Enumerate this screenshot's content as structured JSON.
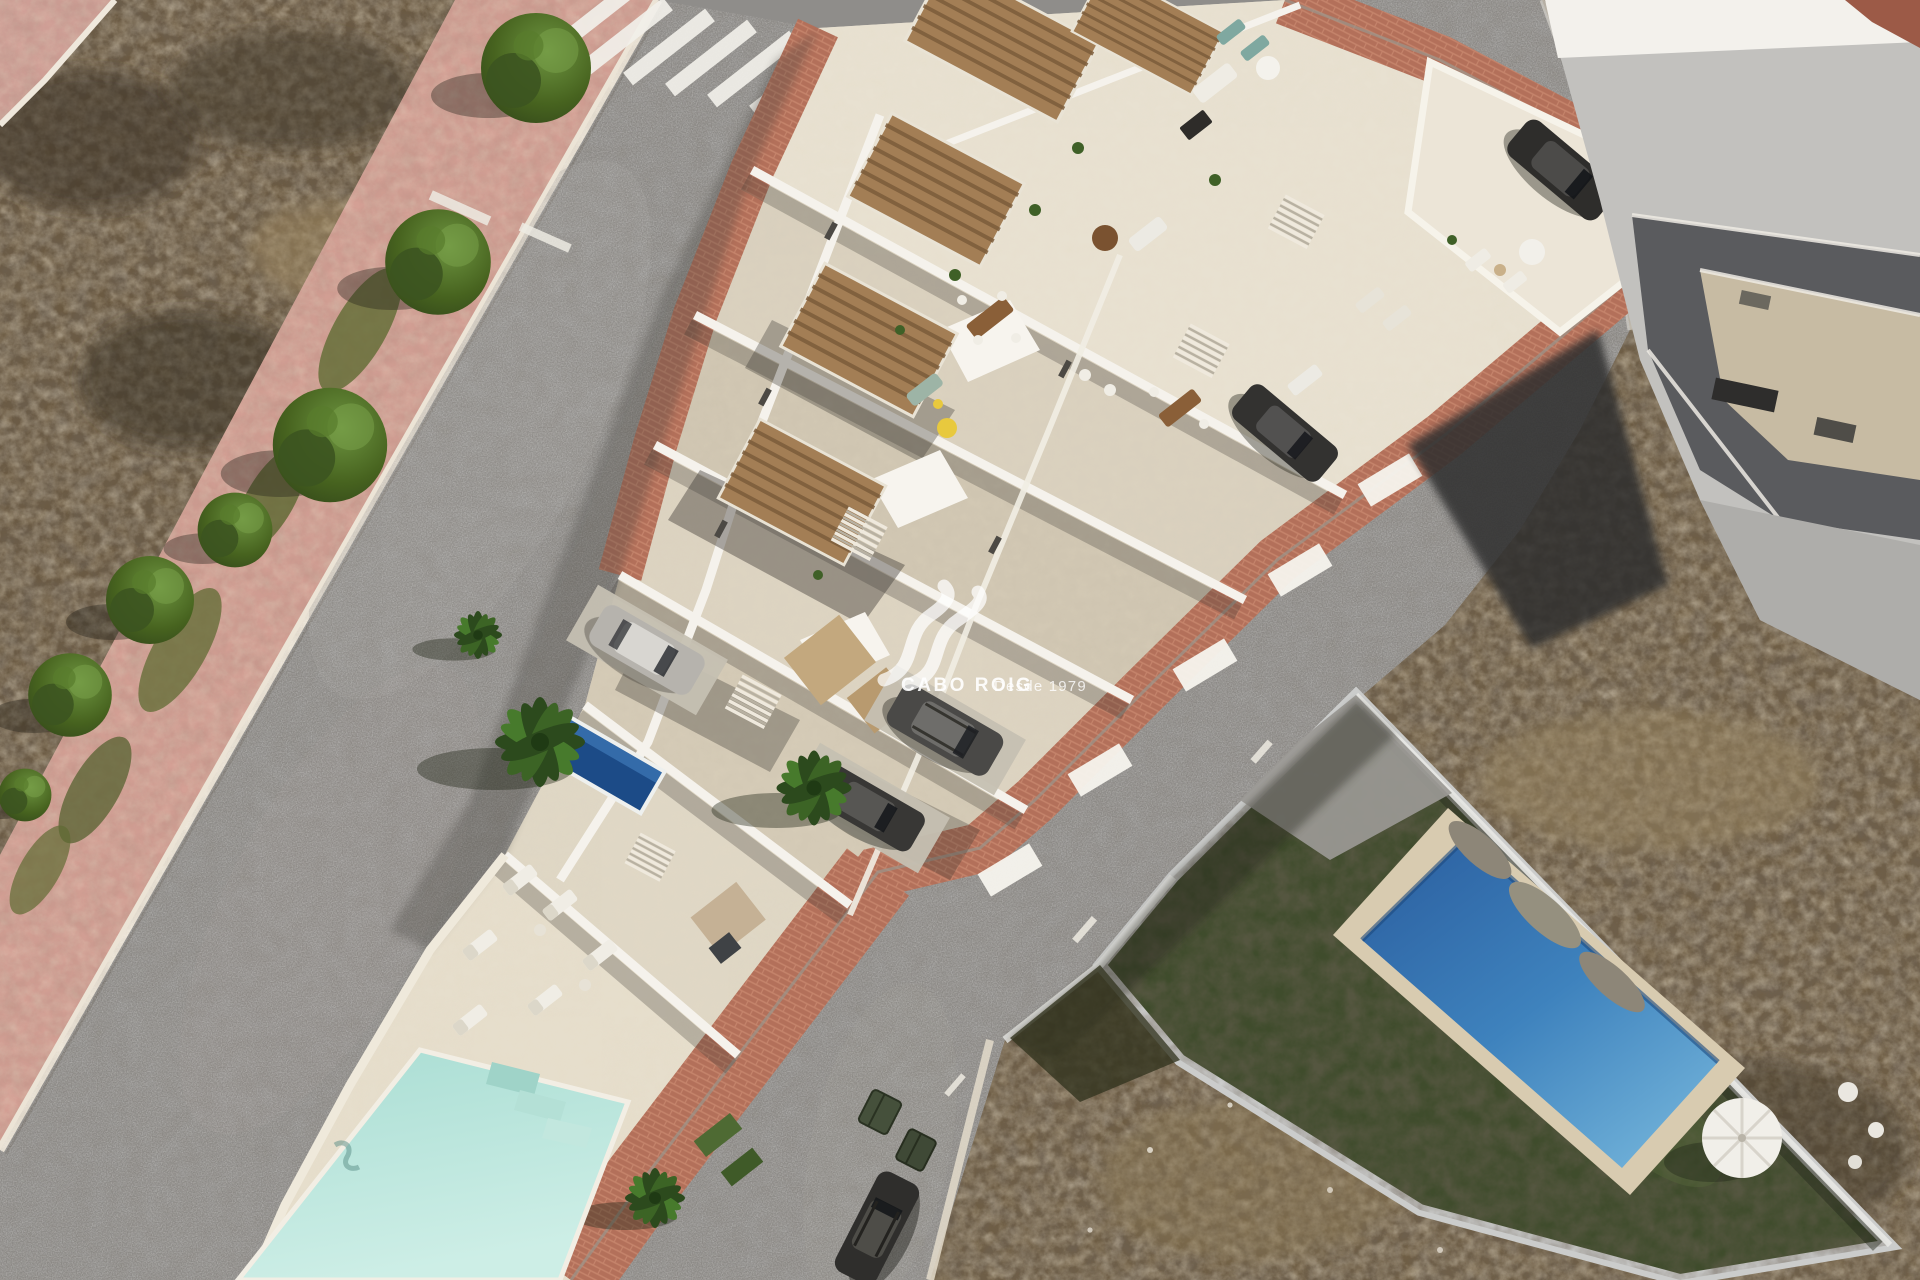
{
  "watermark": {
    "brand": "CABO ROIG",
    "tagline": "Desde 1979"
  },
  "scene": {
    "type": "aerial-3d-architectural-render",
    "description": "Bird's-eye render of a new-build row of white terraced villas with roof terraces, wooden pergolas, private driveways and a wedge-shaped communal pool, flanked by two asphalt streets with a zebra crossing, a salmon-pink tree-lined walkway, dry scrubland, an existing grey flat-roofed house and a neighbouring villa with artificial turf, rectangular blue pool and white parasol.",
    "inventory": {
      "cars": 6,
      "waste_bins": 2,
      "swimming_pools": 3,
      "street_trees": 7,
      "palm_trees": 4,
      "sun_loungers": 6,
      "sun_umbrellas": 2,
      "crosswalk_stripes": 7
    }
  },
  "palette": {
    "asphalt": "#8f8d8a",
    "walkway_pink": "#d4a095",
    "scrubland": "#6b5a42",
    "lot_paving": "#d7cec0",
    "terracotta_sidewalk": "#b3705a",
    "white_walls": "#f3f0e9",
    "pergola_wood": "#a37e55",
    "communal_pool": "#bfe7df",
    "private_pool": "#1c4b87",
    "villa_pool": "#2f6cab",
    "villa_turf": "#3f4c2c",
    "tree_green": "#3f5429",
    "car_dark": "#333230",
    "car_silver": "#b6b3ad",
    "bin_green": "#45503b"
  }
}
